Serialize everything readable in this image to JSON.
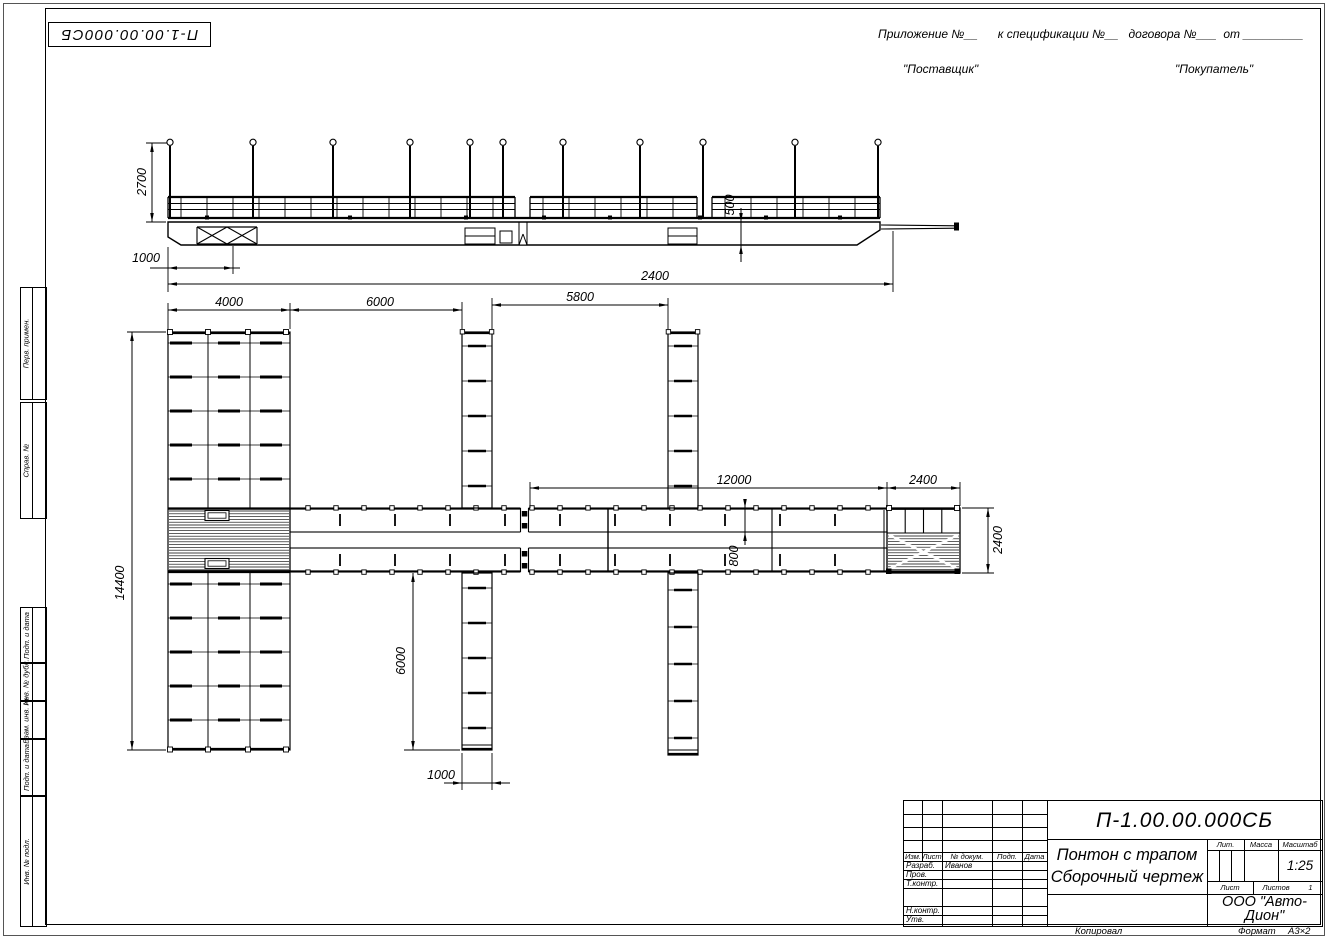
{
  "sheet": {
    "doc_number_top": "П-1.00.00.000СБ",
    "appendix_line": "Приложение №__      к спецификации №__   договора №___  от _________",
    "supplier": "\"Поставщик\"",
    "buyer": "\"Покупатель\""
  },
  "margin_labels": {
    "perv_primen": "Перв. примен.",
    "sprav_no": "Справ. №",
    "podp_data_1": "Подп. и дата",
    "inv_dubl": "Инв. № дубл.",
    "vzam_inv": "Взам. инв. №",
    "podp_data_2": "Подп. и дата",
    "inv_podl": "Инв. № подл."
  },
  "dims": {
    "side_height": "2700",
    "side_offset": "1000",
    "side_draft": "500",
    "side_length": "2400",
    "plan_4000": "4000",
    "plan_6000_top": "6000",
    "plan_5800": "5800",
    "plan_12000": "12000",
    "plan_2400_top": "2400",
    "plan_800": "800",
    "plan_2400_right": "2400",
    "plan_14400": "14400",
    "plan_6000_bottom": "6000",
    "plan_1000_bottom": "1000"
  },
  "title_block": {
    "doc_number": "П-1.00.00.000СБ",
    "product_title": "Понтон с трапом",
    "doc_type": "Сборочный чертеж",
    "company": "ООО \"Авто-Дион\"",
    "scale": "1:25",
    "lit_label": "Лит.",
    "mass_label": "Масса",
    "scale_label": "Масштаб",
    "sheet_label": "Лист",
    "sheets_label": "Листов",
    "sheets_value": "1",
    "col_izm": "Изм.",
    "col_list": "Лист",
    "col_doc": "№ докум.",
    "col_podp": "Подп.",
    "col_data": "Дата",
    "row_razrab": "Разраб.",
    "razrab_name": "Иванов",
    "row_prov": "Пров.",
    "row_tkontr": "Т.контр.",
    "row_nkontr": "Н.контр.",
    "row_utv": "Утв."
  },
  "footer": {
    "copied": "Копировал",
    "format_label": "Формат",
    "format_value": "А3×2"
  }
}
